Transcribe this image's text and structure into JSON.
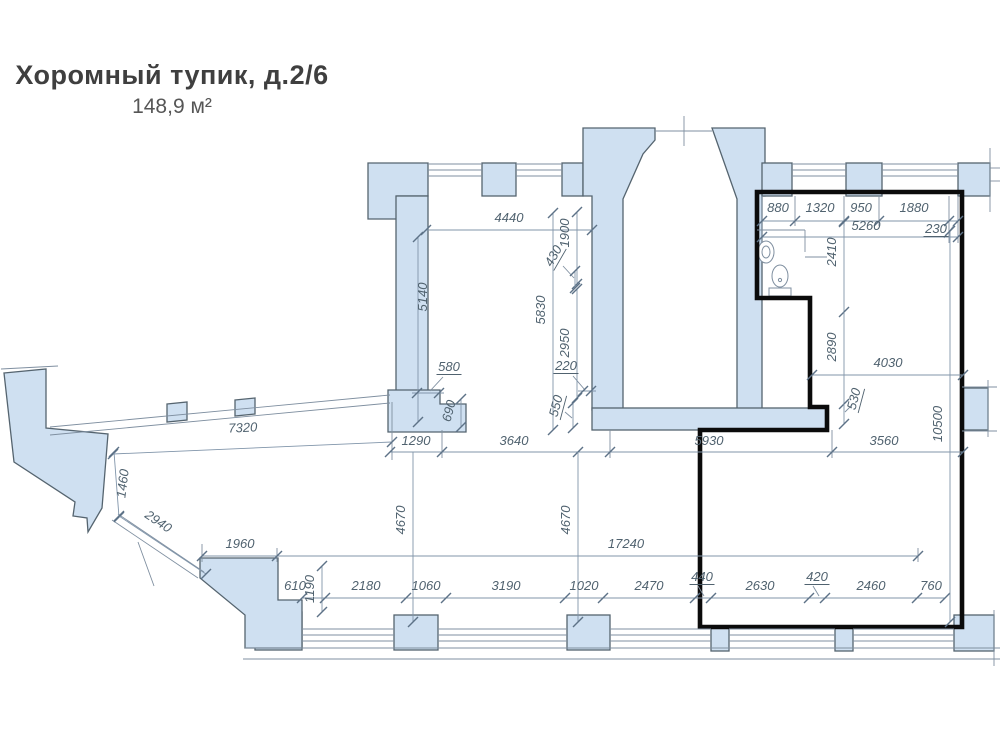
{
  "title": {
    "name": "Хоромный тупик, д.2/6",
    "area": "148,9 м²"
  },
  "plan": {
    "colors": {
      "wall_fill": "#cfe0f1",
      "wall_stroke": "#55646f",
      "dim_line": "#8195aa",
      "dim_text": "#50626f",
      "unit_outline": "#0b0b0b"
    },
    "dim_labels": [
      {
        "t": "4440",
        "x": 509,
        "y": 222,
        "r": 0
      },
      {
        "t": "5140",
        "x": 427,
        "y": 297,
        "r": -90
      },
      {
        "t": "1900",
        "x": 569,
        "y": 233,
        "r": -90
      },
      {
        "t": "430",
        "x": 557,
        "y": 258,
        "r": -60,
        "ul": true
      },
      {
        "t": "5830",
        "x": 545,
        "y": 310,
        "r": -90
      },
      {
        "t": "2950",
        "x": 569,
        "y": 343,
        "r": -90
      },
      {
        "t": "220",
        "x": 566,
        "y": 370,
        "r": 0,
        "ul": true
      },
      {
        "t": "580",
        "x": 449,
        "y": 371,
        "r": 0,
        "ul": true
      },
      {
        "t": "690",
        "x": 453,
        "y": 412,
        "r": -75
      },
      {
        "t": "550",
        "x": 560,
        "y": 407,
        "r": -75,
        "ul": true
      },
      {
        "t": "1290",
        "x": 416,
        "y": 445,
        "r": 0
      },
      {
        "t": "3640",
        "x": 514,
        "y": 445,
        "r": 0
      },
      {
        "t": "5930",
        "x": 709,
        "y": 445,
        "r": 0
      },
      {
        "t": "3560",
        "x": 884,
        "y": 445,
        "r": 0
      },
      {
        "t": "7320",
        "x": 243,
        "y": 432,
        "r": -2.5
      },
      {
        "t": "1460",
        "x": 127,
        "y": 484,
        "r": -83
      },
      {
        "t": "2940",
        "x": 156,
        "y": 525,
        "r": 34
      },
      {
        "t": "1960",
        "x": 240,
        "y": 548,
        "r": 0
      },
      {
        "t": "17240",
        "x": 626,
        "y": 548,
        "r": 0
      },
      {
        "t": "4670",
        "x": 405,
        "y": 520,
        "r": -90
      },
      {
        "t": "4670",
        "x": 570,
        "y": 520,
        "r": -90
      },
      {
        "t": "1190",
        "x": 314,
        "y": 589,
        "r": -90
      },
      {
        "t": "610",
        "x": 295,
        "y": 590,
        "r": 0
      },
      {
        "t": "2180",
        "x": 366,
        "y": 590,
        "r": 0
      },
      {
        "t": "1060",
        "x": 426,
        "y": 590,
        "r": 0
      },
      {
        "t": "3190",
        "x": 506,
        "y": 590,
        "r": 0
      },
      {
        "t": "1020",
        "x": 584,
        "y": 590,
        "r": 0
      },
      {
        "t": "2470",
        "x": 649,
        "y": 590,
        "r": 0
      },
      {
        "t": "440",
        "x": 702,
        "y": 581,
        "r": 0,
        "ul": true
      },
      {
        "t": "2630",
        "x": 760,
        "y": 590,
        "r": 0
      },
      {
        "t": "420",
        "x": 817,
        "y": 581,
        "r": 0,
        "ul": true
      },
      {
        "t": "2460",
        "x": 871,
        "y": 590,
        "r": 0
      },
      {
        "t": "760",
        "x": 931,
        "y": 590,
        "r": 0
      },
      {
        "t": "880",
        "x": 778,
        "y": 212,
        "r": 0
      },
      {
        "t": "1320",
        "x": 820,
        "y": 212,
        "r": 0
      },
      {
        "t": "950",
        "x": 861,
        "y": 212,
        "r": 0
      },
      {
        "t": "1880",
        "x": 914,
        "y": 212,
        "r": 0
      },
      {
        "t": "5260",
        "x": 866,
        "y": 230,
        "r": 0
      },
      {
        "t": "230",
        "x": 936,
        "y": 233,
        "r": 0,
        "ul": true
      },
      {
        "t": "2410",
        "x": 836,
        "y": 252,
        "r": -90
      },
      {
        "t": "2890",
        "x": 836,
        "y": 347,
        "r": -90
      },
      {
        "t": "4030",
        "x": 888,
        "y": 367,
        "r": 0
      },
      {
        "t": "530",
        "x": 858,
        "y": 400,
        "r": -75,
        "ul": true
      },
      {
        "t": "10500",
        "x": 942,
        "y": 424,
        "r": -90
      }
    ],
    "dim_lines": [
      {
        "x1": 426,
        "y1": 230,
        "x2": 592,
        "y2": 230,
        "ticks": [
          [
            426,
            230
          ],
          [
            592,
            230
          ]
        ]
      },
      {
        "x1": 418,
        "y1": 237,
        "x2": 418,
        "y2": 422,
        "ticks": [
          [
            418,
            237
          ],
          [
            418,
            422
          ]
        ]
      },
      {
        "x1": 577,
        "y1": 212,
        "x2": 577,
        "y2": 284,
        "ticks": [
          [
            577,
            212
          ],
          [
            577,
            284
          ]
        ]
      },
      {
        "x1": 575,
        "y1": 271,
        "x2": 575,
        "y2": 288,
        "ticks": [
          [
            575,
            271
          ],
          [
            575,
            288
          ]
        ]
      },
      {
        "x1": 553,
        "y1": 213,
        "x2": 553,
        "y2": 430,
        "ticks": [
          [
            553,
            213
          ],
          [
            553,
            430
          ]
        ]
      },
      {
        "x1": 577,
        "y1": 289,
        "x2": 577,
        "y2": 398,
        "ticks": [
          [
            577,
            289
          ],
          [
            577,
            398
          ]
        ]
      },
      {
        "x1": 578,
        "y1": 391,
        "x2": 596,
        "y2": 391,
        "ticks": [
          [
            583,
            391
          ],
          [
            591,
            391
          ]
        ]
      },
      {
        "x1": 412,
        "y1": 393,
        "x2": 444,
        "y2": 393,
        "ticks": [
          [
            417,
            393
          ],
          [
            439,
            393
          ]
        ]
      },
      {
        "x1": 461,
        "y1": 399,
        "x2": 461,
        "y2": 427,
        "ticks": [
          [
            461,
            399
          ],
          [
            461,
            427
          ]
        ]
      },
      {
        "x1": 573,
        "y1": 403,
        "x2": 573,
        "y2": 428,
        "ticks": [
          [
            573,
            403
          ],
          [
            573,
            428
          ]
        ]
      },
      {
        "x1": 390,
        "y1": 452,
        "x2": 963,
        "y2": 452,
        "ticks": [
          [
            390,
            452
          ],
          [
            442,
            452
          ],
          [
            578,
            452
          ],
          [
            610,
            452
          ],
          [
            832,
            452
          ],
          [
            963,
            452
          ]
        ]
      },
      {
        "x1": 113,
        "y1": 454,
        "x2": 392,
        "y2": 442,
        "ticks": [
          [
            113,
            454
          ],
          [
            392,
            442
          ]
        ]
      },
      {
        "x1": 114,
        "y1": 452,
        "x2": 119,
        "y2": 517,
        "ticks": [
          [
            114,
            452
          ],
          [
            119,
            517
          ]
        ]
      },
      {
        "x1": 119,
        "y1": 516,
        "x2": 206,
        "y2": 574,
        "ticks": [
          [
            119,
            516
          ],
          [
            206,
            574
          ]
        ]
      },
      {
        "x1": 202,
        "y1": 556,
        "x2": 918,
        "y2": 556,
        "ticks": [
          [
            202,
            556
          ],
          [
            277,
            556
          ],
          [
            918,
            556
          ]
        ]
      },
      {
        "x1": 413,
        "y1": 452,
        "x2": 413,
        "y2": 622,
        "ticks": [
          [
            413,
            622
          ]
        ]
      },
      {
        "x1": 578,
        "y1": 452,
        "x2": 578,
        "y2": 622,
        "ticks": [
          [
            578,
            622
          ]
        ]
      },
      {
        "x1": 322,
        "y1": 566,
        "x2": 322,
        "y2": 612,
        "ticks": [
          [
            322,
            566
          ],
          [
            322,
            612
          ]
        ]
      },
      {
        "x1": 302,
        "y1": 598,
        "x2": 945,
        "y2": 598,
        "ticks": [
          [
            302,
            598
          ],
          [
            325,
            598
          ],
          [
            406,
            598
          ],
          [
            446,
            598
          ],
          [
            565,
            598
          ],
          [
            603,
            598
          ],
          [
            695,
            598
          ],
          [
            711,
            598
          ],
          [
            809,
            598
          ],
          [
            825,
            598
          ],
          [
            917,
            598
          ],
          [
            945,
            598
          ]
        ]
      },
      {
        "x1": 762,
        "y1": 221,
        "x2": 958,
        "y2": 221,
        "ticks": [
          [
            762,
            221
          ],
          [
            795,
            221
          ],
          [
            844,
            221
          ],
          [
            879,
            221
          ],
          [
            949,
            221
          ],
          [
            958,
            221
          ]
        ]
      },
      {
        "x1": 762,
        "y1": 237,
        "x2": 958,
        "y2": 237,
        "ticks": [
          [
            762,
            237
          ],
          [
            958,
            237
          ]
        ]
      },
      {
        "x1": 844,
        "y1": 222,
        "x2": 844,
        "y2": 312,
        "ticks": [
          [
            844,
            222
          ],
          [
            844,
            312
          ]
        ]
      },
      {
        "x1": 844,
        "y1": 312,
        "x2": 844,
        "y2": 404,
        "ticks": [
          [
            844,
            404
          ]
        ]
      },
      {
        "x1": 812,
        "y1": 375,
        "x2": 963,
        "y2": 375,
        "ticks": [
          [
            812,
            375
          ],
          [
            963,
            375
          ]
        ]
      },
      {
        "x1": 844,
        "y1": 404,
        "x2": 844,
        "y2": 424,
        "ticks": [
          [
            844,
            424
          ]
        ]
      },
      {
        "x1": 950,
        "y1": 231,
        "x2": 950,
        "y2": 622,
        "ticks": [
          [
            950,
            231
          ],
          [
            950,
            622
          ]
        ]
      }
    ],
    "thin_lines": [
      [
        392,
        402,
        392,
        460
      ],
      [
        442,
        430,
        442,
        458
      ],
      [
        610,
        430,
        610,
        458
      ],
      [
        832,
        430,
        832,
        458
      ],
      [
        202,
        544,
        202,
        562
      ],
      [
        277,
        548,
        277,
        562
      ],
      [
        918,
        548,
        918,
        562
      ],
      [
        762,
        196,
        762,
        243
      ],
      [
        795,
        196,
        795,
        226
      ],
      [
        844,
        196,
        844,
        226
      ],
      [
        879,
        196,
        879,
        226
      ],
      [
        949,
        196,
        949,
        243
      ],
      [
        958,
        196,
        958,
        243
      ],
      [
        655,
        131,
        712,
        131
      ],
      [
        684,
        116,
        684,
        146
      ],
      [
        1,
        369,
        58,
        366
      ],
      [
        990,
        148,
        990,
        212
      ],
      [
        990,
        168,
        1000,
        168
      ],
      [
        990,
        181,
        1000,
        181
      ],
      [
        962,
        387,
        997,
        387
      ],
      [
        962,
        431,
        997,
        431
      ],
      [
        988,
        380,
        988,
        437
      ],
      [
        245,
        648,
        1000,
        648
      ],
      [
        243,
        659,
        1000,
        659
      ],
      [
        994,
        610,
        994,
        666
      ],
      [
        50,
        427,
        390,
        395
      ],
      [
        50,
        435,
        390,
        403
      ],
      [
        118,
        514,
        204,
        572
      ],
      [
        112,
        520,
        198,
        578
      ],
      [
        138,
        542,
        154,
        586
      ],
      [
        757,
        230,
        805,
        230
      ],
      [
        805,
        230,
        805,
        252
      ],
      [
        805,
        257,
        827,
        257
      ],
      [
        563,
        266,
        574,
        278
      ],
      [
        573,
        376,
        585,
        390
      ],
      [
        443,
        377,
        430,
        391
      ],
      [
        565,
        412,
        572,
        418
      ],
      [
        852,
        405,
        845,
        412
      ],
      [
        698,
        586,
        704,
        596
      ],
      [
        813,
        586,
        819,
        596
      ],
      [
        944,
        238,
        955,
        224
      ]
    ],
    "windows": [
      {
        "x1": 428,
        "x2": 482,
        "y": 164
      },
      {
        "x1": 516,
        "x2": 562,
        "y": 164
      },
      {
        "x1": 792,
        "x2": 846,
        "y": 164
      },
      {
        "x1": 882,
        "x2": 958,
        "y": 164
      },
      {
        "x1": 302,
        "x2": 394,
        "y": 629
      },
      {
        "x1": 438,
        "x2": 567,
        "y": 629
      },
      {
        "x1": 610,
        "x2": 711,
        "y": 629
      },
      {
        "x1": 729,
        "x2": 835,
        "y": 629
      },
      {
        "x1": 853,
        "x2": 954,
        "y": 629
      }
    ]
  }
}
